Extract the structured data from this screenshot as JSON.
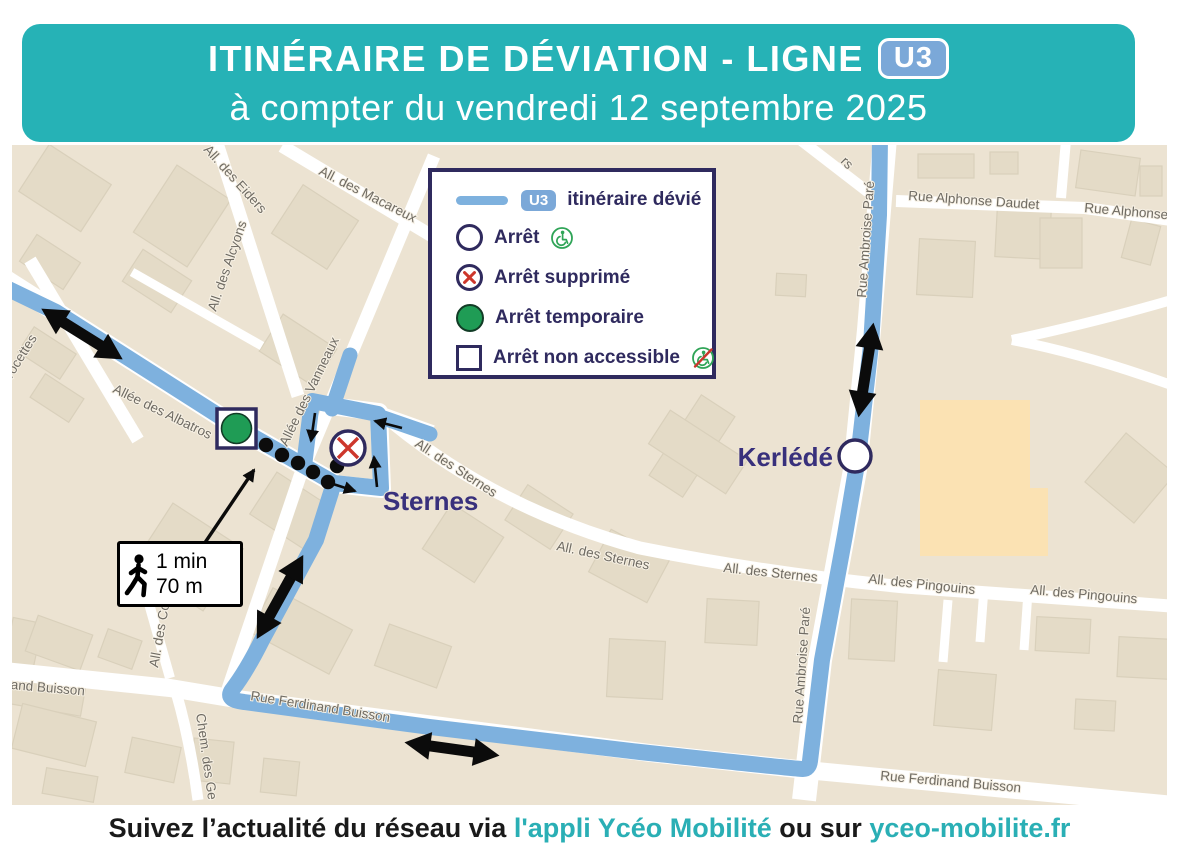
{
  "header": {
    "title": "ITINÉRAIRE DE DÉVIATION - LIGNE",
    "line_badge": "U3",
    "subtitle": "à compter du vendredi 12 septembre 2025"
  },
  "legend": {
    "route_badge": "U3",
    "route_label": "itinéraire dévié",
    "rows": {
      "stop": "Arrêt",
      "removed": "Arrêt supprimé",
      "temporary": "Arrêt temporaire",
      "not_accessible": "Arrêt non accessible"
    }
  },
  "map": {
    "stops": {
      "sternes": "Sternes",
      "kerlede": "Kerlédé"
    },
    "walk_note": {
      "duration": "1 min",
      "distance": "70 m"
    },
    "street_labels": [
      {
        "label": "Avocettes"
      },
      {
        "label": "All. des Eiders"
      },
      {
        "label": "All. des Alcyons"
      },
      {
        "label": "All. des Macareux"
      },
      {
        "label": "Allée des Albatros"
      },
      {
        "label": "Allée des Vanneaux"
      },
      {
        "label": "All. des Sternes"
      },
      {
        "label": "All. des Sternes"
      },
      {
        "label": "All. des Sternes"
      },
      {
        "label": "All. des Pingouins"
      },
      {
        "label": "All. des Pingouins"
      },
      {
        "label": "Rue Ambroise Paré"
      },
      {
        "label": "Rue Ambroise Paré"
      },
      {
        "label": "Rue Alphonse Daudet"
      },
      {
        "label": "Rue Alphonse"
      },
      {
        "label": "Rue Ferdinand Buisson"
      },
      {
        "label": "inand Buisson"
      },
      {
        "label": "Rue Ferdinand Buisson"
      },
      {
        "label": "All. des Co"
      },
      {
        "label": "Chem. des Ge"
      },
      {
        "label": "rs"
      }
    ]
  },
  "footer": {
    "prefix": "Suivez l’actualité du réseau via",
    "link_app": "l'appli Ycéo Mobilité",
    "connector": "ou sur",
    "link_site": "yceo-mobilite.fr"
  },
  "colors": {
    "teal": "#26b2b6",
    "navy": "#2f2a5e",
    "route_blue": "#7eb1de",
    "badge_blue": "#7ba8d8",
    "stop_green": "#1f9c55",
    "removed_red": "#cd372c",
    "map_bg": "#ece3d2"
  }
}
